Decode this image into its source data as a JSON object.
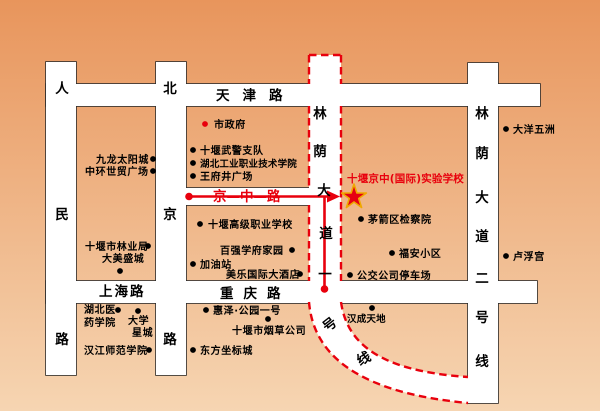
{
  "colors": {
    "bg_top": "#e8955c",
    "bg_bottom": "#f6d5b2",
    "road_fill": "#ffffff",
    "road_border": "#2b2b2b",
    "accent_red": "#e8000d",
    "star_fill": "#e60012",
    "star_stroke": "#f0a800"
  },
  "school": {
    "name": "十堰京中(国际)实验学校"
  },
  "route": {
    "name": "京—中—路"
  },
  "roads": {
    "tianjin": {
      "label": "天津路"
    },
    "shanghai": {
      "label": "上海路"
    },
    "chongqing": {
      "label": "重庆路"
    },
    "renmin": {
      "chars": [
        "人",
        "民",
        "路"
      ]
    },
    "beijing": {
      "chars": [
        "北",
        "京",
        "路"
      ]
    },
    "linyin1": {
      "chars": [
        "林",
        "荫",
        "大",
        "道",
        "一",
        "号",
        "线"
      ]
    },
    "linyin2": {
      "chars": [
        "林",
        "荫",
        "大",
        "道",
        "二",
        "号",
        "线"
      ]
    }
  },
  "pois": [
    {
      "name": "市政府"
    },
    {
      "name": "十堰武警支队"
    },
    {
      "name": "湖北工业职业技术学院"
    },
    {
      "name": "王府井广场"
    },
    {
      "name": "九龙太阳城"
    },
    {
      "name": "中环世贸广场"
    },
    {
      "name": "十堰市林业局"
    },
    {
      "name": "大美盛城"
    },
    {
      "name": "十堰高级职业学校"
    },
    {
      "name": "百强学府家园"
    },
    {
      "name": "加油站"
    },
    {
      "name": "美乐国际大酒店"
    },
    {
      "name": "茅箭区检察院"
    },
    {
      "name": "福安小区"
    },
    {
      "name": "公交公司停车场"
    },
    {
      "name": "大洋五洲"
    },
    {
      "name": "卢浮宫"
    },
    {
      "line1": "湖北医",
      "line2": "药学院"
    },
    {
      "line1": "大学",
      "line2": "星城"
    },
    {
      "name": "汉江师范学院"
    },
    {
      "name": "惠泽·公园一号"
    },
    {
      "name": "十堰市烟草公司"
    },
    {
      "name": "东方坐标城"
    },
    {
      "name": "汉成天地"
    }
  ]
}
